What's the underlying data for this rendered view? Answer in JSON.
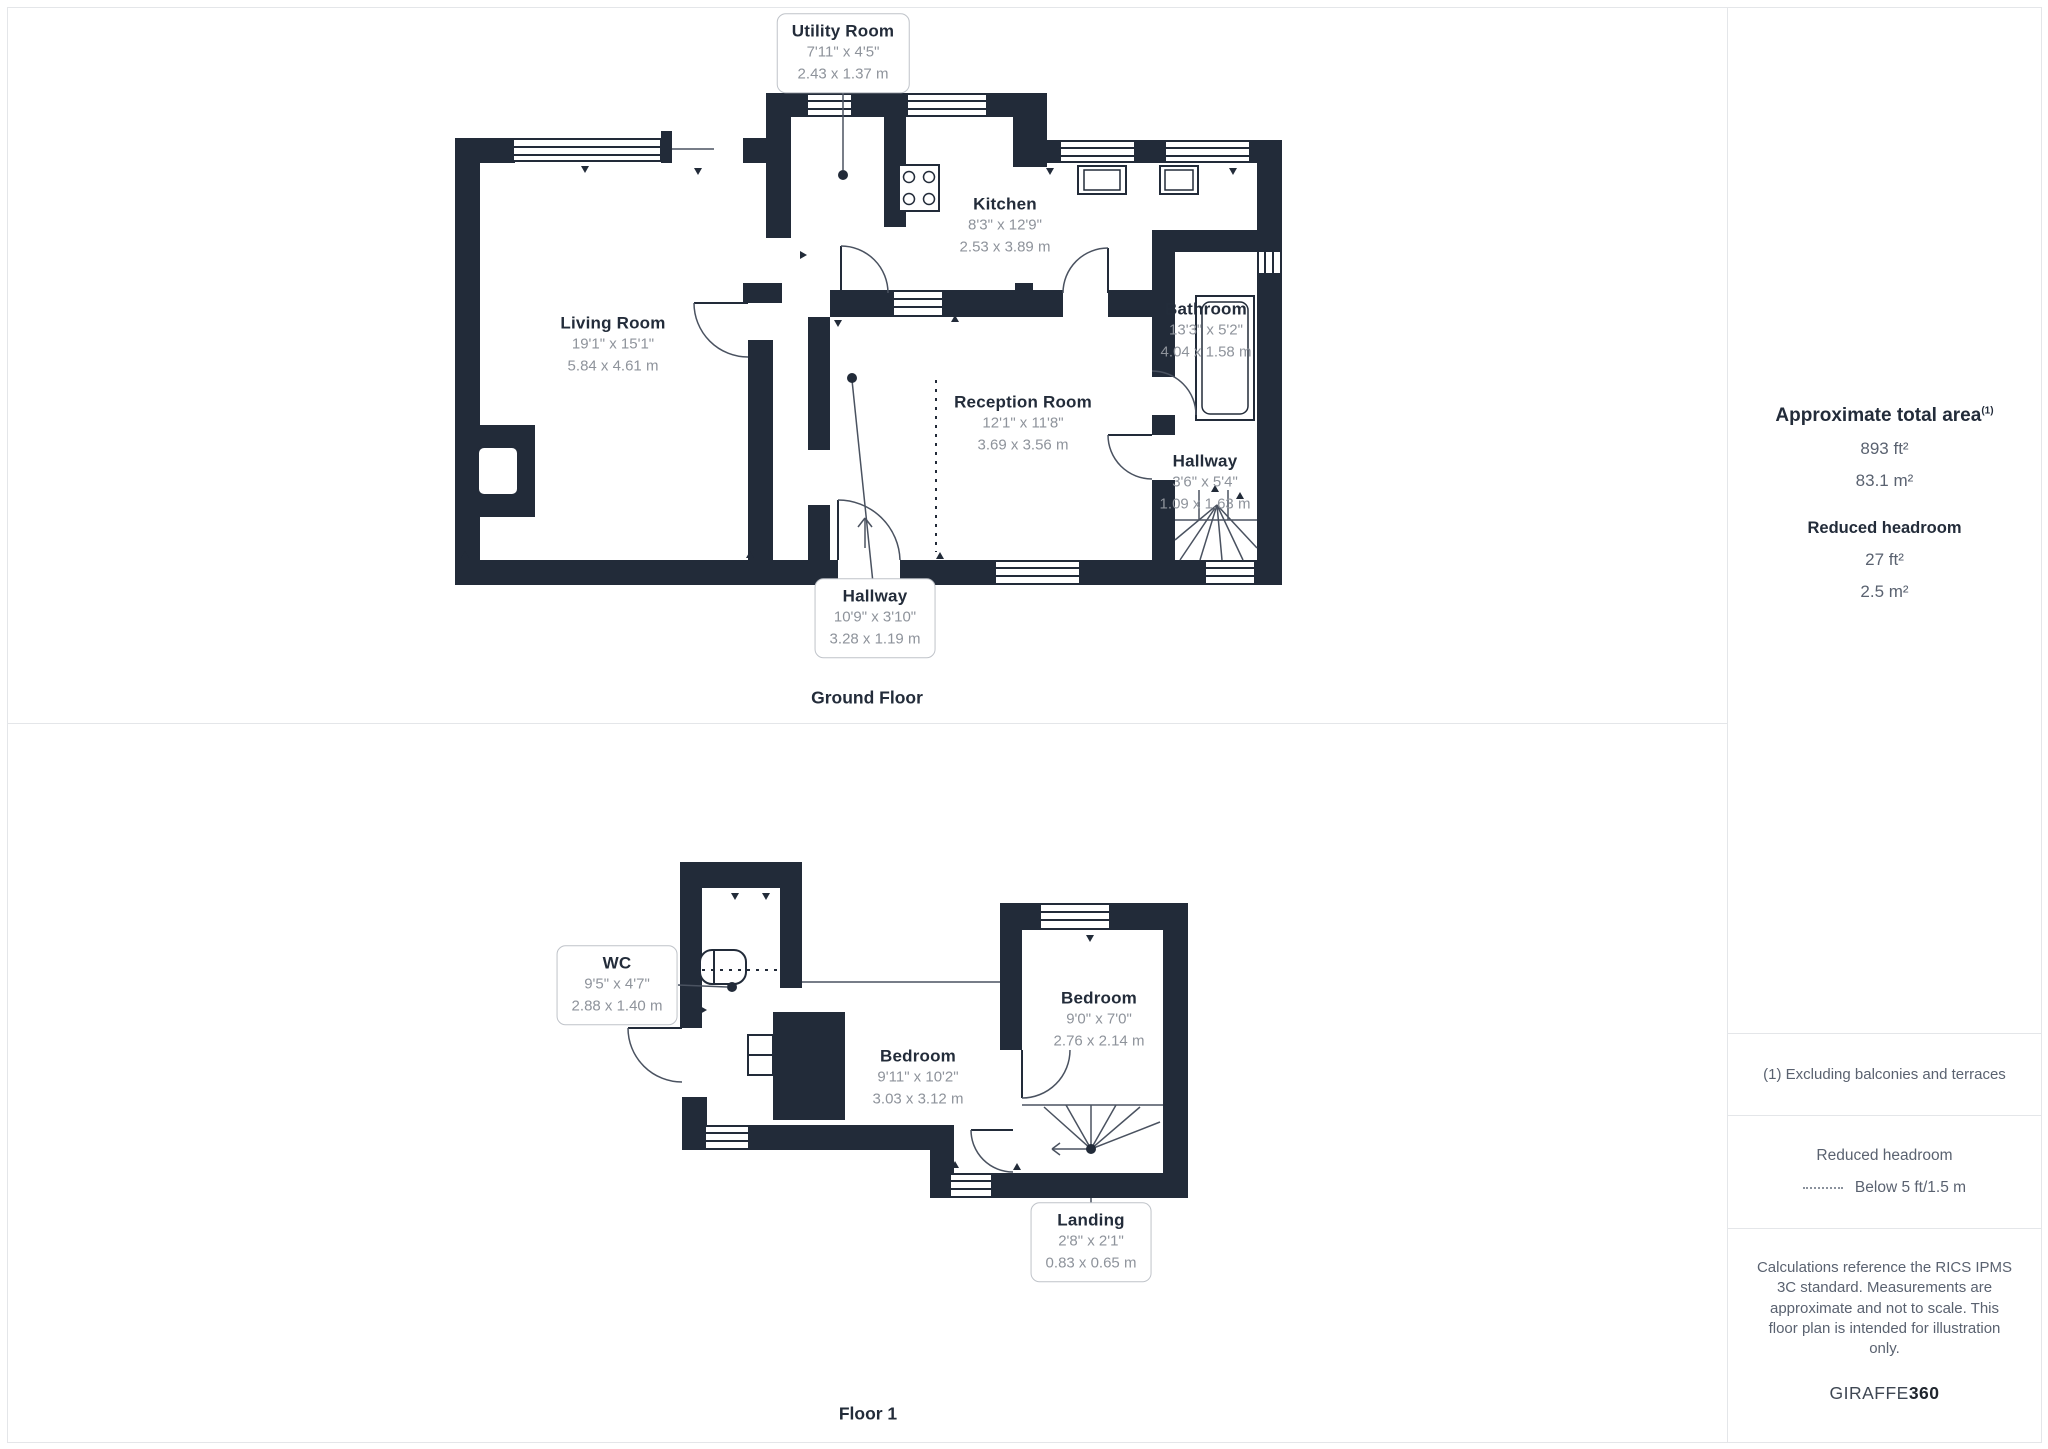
{
  "ground_floor": {
    "title": "Ground Floor",
    "utility": {
      "name": "Utility Room",
      "imperial": "7'11\" x 4'5\"",
      "metric": "2.43 x 1.37 m"
    },
    "kitchen": {
      "name": "Kitchen",
      "imperial": "8'3\" x 12'9\"",
      "metric": "2.53 x 3.89 m"
    },
    "living": {
      "name": "Living Room",
      "imperial": "19'1\" x 15'1\"",
      "metric": "5.84 x 4.61 m"
    },
    "reception": {
      "name": "Reception Room",
      "imperial": "12'1\" x 11'8\"",
      "metric": "3.69 x 3.56 m"
    },
    "bathroom": {
      "name": "Bathroom",
      "imperial": "13'3\" x 5'2\"",
      "metric": "4.04 x 1.58 m"
    },
    "hallway_side": {
      "name": "Hallway",
      "imperial": "3'6\" x 5'4\"",
      "metric": "1.09 x 1.63 m"
    },
    "hallway_main": {
      "name": "Hallway",
      "imperial": "10'9\" x 3'10\"",
      "metric": "3.28 x 1.19 m"
    }
  },
  "floor_1": {
    "title": "Floor 1",
    "wc": {
      "name": "WC",
      "imperial": "9'5\" x 4'7\"",
      "metric": "2.88 x 1.40 m"
    },
    "bedroom_main": {
      "name": "Bedroom",
      "imperial": "9'11\" x 10'2\"",
      "metric": "3.03 x 3.12 m"
    },
    "bedroom_small": {
      "name": "Bedroom",
      "imperial": "9'0\" x 7'0\"",
      "metric": "2.76 x 2.14 m"
    },
    "landing": {
      "name": "Landing",
      "imperial": "2'8\" x 2'1\"",
      "metric": "0.83 x 0.65 m"
    }
  },
  "sidebar": {
    "area_heading": "Approximate total area",
    "area_note_ref": "(1)",
    "area_ft": "893 ft²",
    "area_m": "83.1 m²",
    "reduced_heading": "Reduced headroom",
    "reduced_ft": "27 ft²",
    "reduced_m": "2.5 m²",
    "note1": "(1) Excluding balconies and terraces",
    "legend_heading": "Reduced headroom",
    "legend_label": "Below 5 ft/1.5 m",
    "disclaimer": "Calculations reference the RICS IPMS 3C standard. Measurements are approximate and not to scale. This floor plan is intended for illustration only.",
    "brand_left": "GIRAFFE",
    "brand_right": "360"
  },
  "colors": {
    "wall": "#222b39",
    "dim_text": "#8e939b",
    "side_text": "#5a6270",
    "divider": "#e4e6e9"
  }
}
